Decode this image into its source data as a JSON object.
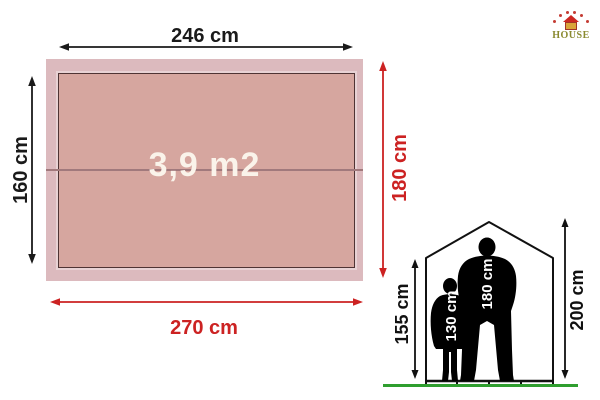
{
  "logo": {
    "brand": "HOUSE",
    "brand_color": "#8a8a2f",
    "roof_color": "#cc2822",
    "arc_dot_color": "#c43b33"
  },
  "floor_plan": {
    "area_label": "3,9 m2",
    "inner_width_label": "246 cm",
    "inner_depth_label": "160 cm",
    "outer_width_label": "270 cm",
    "outer_depth_label": "180 cm",
    "colors": {
      "outer_fill": "#dcbabe",
      "inner_fill": "#d6a69f",
      "inner_border": "#4f3434",
      "center_line": "#a1797c",
      "black_dimension": "#1a1a1a",
      "red_dimension": "#cc2222",
      "area_text": "#faf3ea"
    }
  },
  "elevation": {
    "wall_height_label": "155 cm",
    "ridge_height_label": "200 cm",
    "child_height_label": "130 cm",
    "adult_height_label": "180 cm",
    "frame_color": "#111111",
    "silhouette_color": "#000000",
    "figure_label_color": "#ffffff",
    "ground_color": "#2f9e2f"
  }
}
